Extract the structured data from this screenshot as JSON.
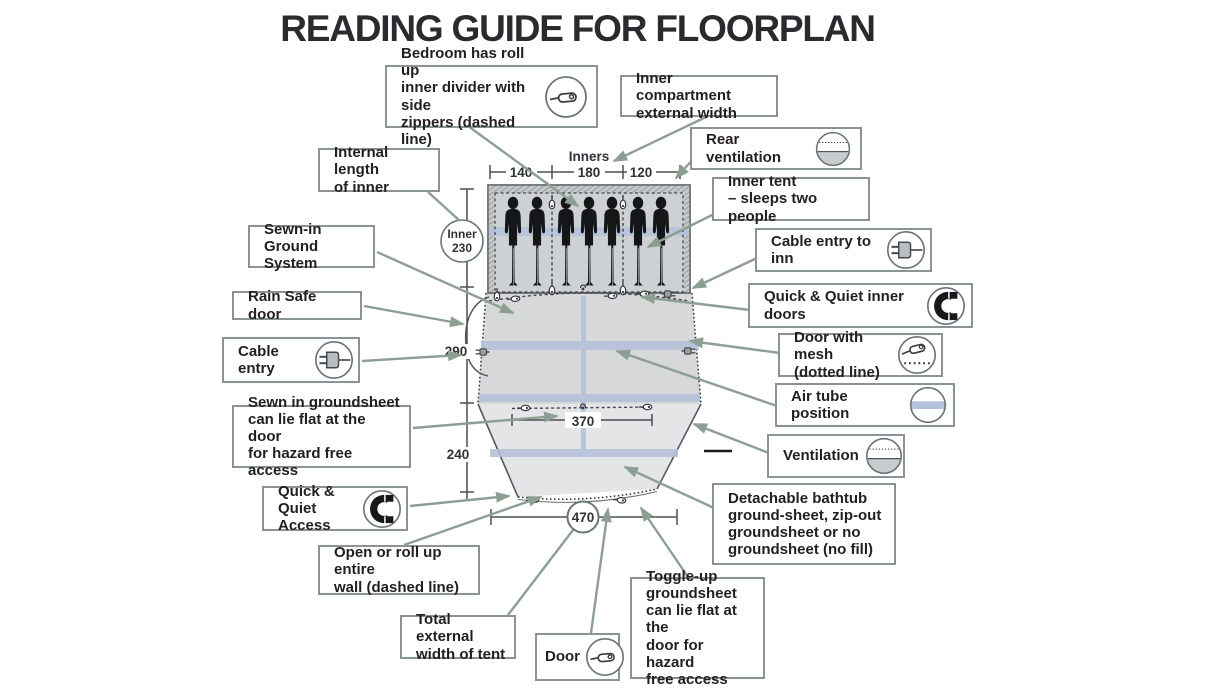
{
  "title": "READING GUIDE FOR FLOORPLAN",
  "colors": {
    "connector": "#8d9f92",
    "box_border": "#8a9398",
    "text": "#231f20",
    "tent_outline": "#565b60",
    "bedroom_fill": "#ced1d3",
    "living_fill": "#d6d8da",
    "porch_fill": "#e3e5e7",
    "air_tube": "#b5c1da",
    "silhouette": "#151617"
  },
  "measurements": {
    "inners_label": "Inners",
    "inner_widths": [
      "140",
      "180",
      "120"
    ],
    "inner_circle": {
      "label": "Inner",
      "value": "230"
    },
    "living_depth": "290",
    "front_depth": "240",
    "inner_door_width": "370",
    "total_width": "470"
  },
  "callouts": [
    {
      "id": "bedroom-divider",
      "icon": "zipper-icon",
      "lines": [
        "Bedroom has roll up",
        "inner divider with side",
        "zippers (dashed line)"
      ]
    },
    {
      "id": "inner-compartment-width",
      "icon": null,
      "lines": [
        "Inner compartment",
        "external width"
      ]
    },
    {
      "id": "rear-ventilation",
      "icon": "ventilation-icon",
      "lines": [
        "Rear ventilation"
      ]
    },
    {
      "id": "inner-tent",
      "icon": null,
      "lines": [
        "Inner tent",
        "– sleeps two people"
      ]
    },
    {
      "id": "cable-entry-inner",
      "icon": "plug-icon",
      "lines": [
        "Cable entry to inn"
      ]
    },
    {
      "id": "quick-quiet-inner-doors",
      "icon": "magnet-icon",
      "lines": [
        "Quick & Quiet inner doors"
      ]
    },
    {
      "id": "door-with-mesh",
      "icon": "zipper-dotted-icon",
      "lines": [
        "Door with mesh",
        "(dotted line)"
      ]
    },
    {
      "id": "air-tube-position",
      "icon": "air-tube-icon",
      "lines": [
        "Air tube position"
      ]
    },
    {
      "id": "ventilation",
      "icon": "ventilation-icon",
      "lines": [
        "Ventilation"
      ]
    },
    {
      "id": "detachable-bathtub",
      "icon": null,
      "lines": [
        "Detachable bathtub",
        "ground-sheet, zip-out",
        "groundsheet or no",
        "groundsheet (no fill)"
      ]
    },
    {
      "id": "internal-length",
      "icon": null,
      "lines": [
        "Internal length",
        "of inner"
      ]
    },
    {
      "id": "sewn-in-ground-system",
      "icon": null,
      "lines": [
        "Sewn-in Ground",
        "System"
      ]
    },
    {
      "id": "rain-safe-door",
      "icon": null,
      "lines": [
        "Rain Safe door"
      ]
    },
    {
      "id": "cable-entry",
      "icon": "plug-icon",
      "lines": [
        "Cable entry"
      ]
    },
    {
      "id": "sewn-in-groundsheet",
      "icon": null,
      "lines": [
        "Sewn in groundsheet",
        "can lie flat at the door",
        "for hazard free access"
      ]
    },
    {
      "id": "quick-quiet-access",
      "icon": "magnet-icon",
      "lines": [
        "Quick & Quiet",
        "Access"
      ]
    },
    {
      "id": "open-roll-wall",
      "icon": null,
      "lines": [
        "Open or roll up entire",
        "wall (dashed line)"
      ]
    },
    {
      "id": "total-external-width",
      "icon": null,
      "lines": [
        "Total external",
        "width of tent"
      ]
    },
    {
      "id": "door",
      "icon": "zipper-icon",
      "lines": [
        "Door"
      ]
    },
    {
      "id": "toggle-up-groundsheet",
      "icon": null,
      "lines": [
        "Toggle-up",
        "groundsheet",
        "can lie flat at the",
        "door for hazard",
        "free access"
      ]
    }
  ]
}
